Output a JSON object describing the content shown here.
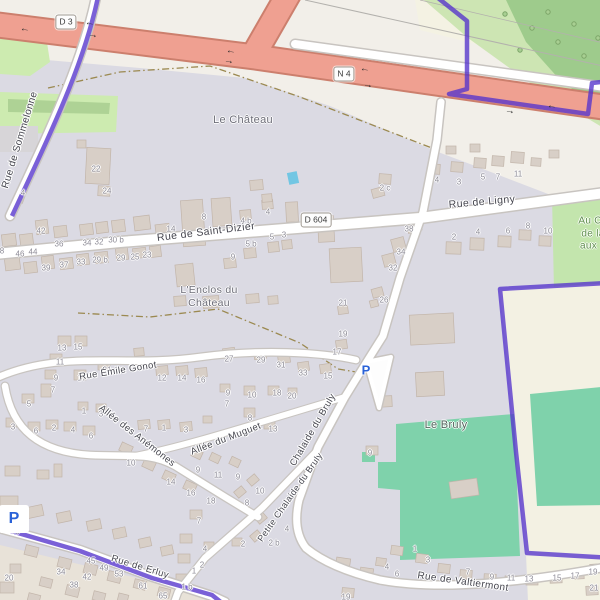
{
  "map": {
    "shields": [
      {
        "t": "D 3",
        "x": 66,
        "y": 22
      },
      {
        "t": "N 4",
        "x": 344,
        "y": 74
      },
      {
        "t": "D 604",
        "x": 316,
        "y": 220
      }
    ],
    "street_labels": [
      {
        "t": "Rue de Sommelonne",
        "x": 20,
        "y": 140,
        "r": -73,
        "s": 10
      },
      {
        "t": "Rue de Saint-Dizier",
        "x": 206,
        "y": 232,
        "r": -7,
        "s": 10.5
      },
      {
        "t": "Rue de Ligny",
        "x": 482,
        "y": 202,
        "r": -5,
        "s": 10.5
      },
      {
        "t": "Rue Émile Gonot",
        "x": 118,
        "y": 371,
        "r": -9,
        "s": 9.5
      },
      {
        "t": "Allée des Anémones",
        "x": 137,
        "y": 436,
        "r": 38,
        "s": 9.5
      },
      {
        "t": "Allée du Muguet",
        "x": 226,
        "y": 439,
        "r": -21,
        "s": 9.5
      },
      {
        "t": "Chalaide du Bruly",
        "x": 313,
        "y": 430,
        "r": -60,
        "s": 9.5
      },
      {
        "t": "Petite Chalaide du Bruly",
        "x": 290,
        "y": 497,
        "r": -55,
        "s": 9
      },
      {
        "t": "Rue de Erluy",
        "x": 140,
        "y": 567,
        "r": 17,
        "s": 9.5
      },
      {
        "t": "Rue de Valtiermont",
        "x": 463,
        "y": 582,
        "r": 8,
        "s": 10
      }
    ],
    "place_labels": [
      {
        "t": "Le Château",
        "x": 243,
        "y": 120,
        "s": 11,
        "c": "#6d6d78"
      },
      {
        "lines": [
          "L'Enclos du",
          "Château"
        ],
        "x": 209,
        "y": 297,
        "s": 10.5,
        "c": "#6d6d78"
      },
      {
        "t": "Le Bruly",
        "x": 446,
        "y": 425,
        "s": 11,
        "c": "#55655d"
      },
      {
        "lines": [
          "Au Ch",
          "de la",
          "aux L"
        ],
        "x": 593,
        "y": 234,
        "s": 10,
        "c": "#5f8f4d"
      }
    ],
    "parking_icons": [
      {
        "t": "P",
        "x": 366,
        "y": 370
      },
      {
        "t": "P",
        "x": 14,
        "y": 519,
        "b": true
      }
    ],
    "oneway_arrows": [
      {
        "g": "←",
        "x": 25,
        "y": 29,
        "r": 9
      },
      {
        "g": "←",
        "x": 90,
        "y": 23,
        "r": 9
      },
      {
        "g": "→",
        "x": 93,
        "y": 35,
        "r": 9
      },
      {
        "g": "←",
        "x": 231,
        "y": 51,
        "r": 9
      },
      {
        "g": "→",
        "x": 229,
        "y": 61,
        "r": 9
      },
      {
        "g": "←",
        "x": 365,
        "y": 69,
        "r": 9
      },
      {
        "g": "→",
        "x": 368,
        "y": 85,
        "r": 9
      },
      {
        "g": "→",
        "x": 510,
        "y": 111,
        "r": 9
      },
      {
        "g": "←",
        "x": 552,
        "y": 106,
        "r": 9
      }
    ],
    "house_numbers": [
      {
        "t": "8",
        "x": 2,
        "y": 251
      },
      {
        "t": "46",
        "x": 20,
        "y": 254
      },
      {
        "t": "44",
        "x": 33,
        "y": 252
      },
      {
        "t": "42",
        "x": 41,
        "y": 231
      },
      {
        "t": "36",
        "x": 59,
        "y": 244
      },
      {
        "t": "34",
        "x": 87,
        "y": 243
      },
      {
        "t": "32",
        "x": 99,
        "y": 242
      },
      {
        "t": "30 b",
        "x": 116,
        "y": 240
      },
      {
        "t": "39",
        "x": 46,
        "y": 268
      },
      {
        "t": "37",
        "x": 64,
        "y": 265
      },
      {
        "t": "33",
        "x": 81,
        "y": 262
      },
      {
        "t": "29 b",
        "x": 100,
        "y": 260
      },
      {
        "t": "29",
        "x": 121,
        "y": 258
      },
      {
        "t": "25",
        "x": 135,
        "y": 257
      },
      {
        "t": "23",
        "x": 147,
        "y": 255
      },
      {
        "t": "14",
        "x": 171,
        "y": 229
      },
      {
        "t": "8",
        "x": 204,
        "y": 217
      },
      {
        "t": "4 b",
        "x": 246,
        "y": 221
      },
      {
        "t": "4",
        "x": 268,
        "y": 212
      },
      {
        "t": "5 b",
        "x": 251,
        "y": 244
      },
      {
        "t": "5",
        "x": 272,
        "y": 237
      },
      {
        "t": "3",
        "x": 284,
        "y": 235
      },
      {
        "t": "9",
        "x": 233,
        "y": 257
      },
      {
        "t": "22",
        "x": 96,
        "y": 169
      },
      {
        "t": "24",
        "x": 107,
        "y": 191
      },
      {
        "t": "4",
        "x": 23,
        "y": 193
      },
      {
        "t": "2 c",
        "x": 385,
        "y": 188
      },
      {
        "t": "4",
        "x": 437,
        "y": 180
      },
      {
        "t": "3",
        "x": 459,
        "y": 182
      },
      {
        "t": "5",
        "x": 483,
        "y": 177
      },
      {
        "t": "7",
        "x": 498,
        "y": 177
      },
      {
        "t": "11",
        "x": 518,
        "y": 174
      },
      {
        "t": "2",
        "x": 454,
        "y": 237
      },
      {
        "t": "4",
        "x": 478,
        "y": 232
      },
      {
        "t": "6",
        "x": 508,
        "y": 231
      },
      {
        "t": "8",
        "x": 528,
        "y": 226
      },
      {
        "t": "10",
        "x": 548,
        "y": 231
      },
      {
        "t": "38",
        "x": 409,
        "y": 229
      },
      {
        "t": "34",
        "x": 401,
        "y": 252
      },
      {
        "t": "32",
        "x": 393,
        "y": 268
      },
      {
        "t": "26",
        "x": 384,
        "y": 300
      },
      {
        "t": "21",
        "x": 343,
        "y": 303
      },
      {
        "t": "19",
        "x": 343,
        "y": 334
      },
      {
        "t": "17",
        "x": 337,
        "y": 352
      },
      {
        "t": "15",
        "x": 328,
        "y": 376
      },
      {
        "t": "33",
        "x": 303,
        "y": 373
      },
      {
        "t": "31",
        "x": 281,
        "y": 365
      },
      {
        "t": "18",
        "x": 277,
        "y": 393
      },
      {
        "t": "20",
        "x": 292,
        "y": 396
      },
      {
        "t": "13",
        "x": 273,
        "y": 429
      },
      {
        "t": "13",
        "x": 62,
        "y": 348
      },
      {
        "t": "15",
        "x": 78,
        "y": 347
      },
      {
        "t": "11",
        "x": 60,
        "y": 362
      },
      {
        "t": "9",
        "x": 56,
        "y": 378
      },
      {
        "t": "7",
        "x": 53,
        "y": 390
      },
      {
        "t": "17",
        "x": 82,
        "y": 378
      },
      {
        "t": "21",
        "x": 107,
        "y": 370
      },
      {
        "t": "12",
        "x": 162,
        "y": 378
      },
      {
        "t": "14",
        "x": 182,
        "y": 378
      },
      {
        "t": "16",
        "x": 201,
        "y": 380
      },
      {
        "t": "27",
        "x": 229,
        "y": 359
      },
      {
        "t": "29",
        "x": 261,
        "y": 360
      },
      {
        "t": "9",
        "x": 228,
        "y": 393
      },
      {
        "t": "7",
        "x": 227,
        "y": 404
      },
      {
        "t": "10",
        "x": 252,
        "y": 395
      },
      {
        "t": "5",
        "x": 29,
        "y": 404
      },
      {
        "t": "3",
        "x": 13,
        "y": 427
      },
      {
        "t": "6",
        "x": 36,
        "y": 431
      },
      {
        "t": "2",
        "x": 54,
        "y": 428
      },
      {
        "t": "4",
        "x": 73,
        "y": 430
      },
      {
        "t": "6",
        "x": 91,
        "y": 436
      },
      {
        "t": "1",
        "x": 84,
        "y": 411
      },
      {
        "t": "3",
        "x": 101,
        "y": 414
      },
      {
        "t": "7",
        "x": 146,
        "y": 429
      },
      {
        "t": "1",
        "x": 164,
        "y": 428
      },
      {
        "t": "3",
        "x": 186,
        "y": 430
      },
      {
        "t": "8",
        "x": 250,
        "y": 418
      },
      {
        "t": "10",
        "x": 131,
        "y": 463
      },
      {
        "t": "14",
        "x": 171,
        "y": 482
      },
      {
        "t": "16",
        "x": 191,
        "y": 493
      },
      {
        "t": "18",
        "x": 211,
        "y": 501
      },
      {
        "t": "9",
        "x": 198,
        "y": 470
      },
      {
        "t": "11",
        "x": 218,
        "y": 475
      },
      {
        "t": "9",
        "x": 238,
        "y": 477
      },
      {
        "t": "7",
        "x": 199,
        "y": 521
      },
      {
        "t": "10",
        "x": 260,
        "y": 491
      },
      {
        "t": "8",
        "x": 247,
        "y": 503
      },
      {
        "t": "4",
        "x": 287,
        "y": 529
      },
      {
        "t": "2 b",
        "x": 274,
        "y": 543
      },
      {
        "t": "2",
        "x": 243,
        "y": 544
      },
      {
        "t": "4",
        "x": 205,
        "y": 549
      },
      {
        "t": "2",
        "x": 202,
        "y": 565
      },
      {
        "t": "1",
        "x": 194,
        "y": 571
      },
      {
        "t": "1 b",
        "x": 187,
        "y": 587
      },
      {
        "t": "41",
        "x": 15,
        "y": 531
      },
      {
        "t": "45",
        "x": 91,
        "y": 561
      },
      {
        "t": "49",
        "x": 104,
        "y": 568
      },
      {
        "t": "53",
        "x": 119,
        "y": 574
      },
      {
        "t": "61",
        "x": 143,
        "y": 586
      },
      {
        "t": "65",
        "x": 163,
        "y": 596
      },
      {
        "t": "34",
        "x": 61,
        "y": 572
      },
      {
        "t": "38",
        "x": 74,
        "y": 585
      },
      {
        "t": "42",
        "x": 87,
        "y": 577
      },
      {
        "t": "20",
        "x": 9,
        "y": 578
      },
      {
        "t": "4",
        "x": 387,
        "y": 567
      },
      {
        "t": "6",
        "x": 397,
        "y": 574
      },
      {
        "t": "1",
        "x": 415,
        "y": 549
      },
      {
        "t": "3",
        "x": 428,
        "y": 560
      },
      {
        "t": "7",
        "x": 468,
        "y": 572
      },
      {
        "t": "9",
        "x": 492,
        "y": 577
      },
      {
        "t": "11",
        "x": 511,
        "y": 578
      },
      {
        "t": "13",
        "x": 529,
        "y": 579
      },
      {
        "t": "15",
        "x": 557,
        "y": 578
      },
      {
        "t": "17",
        "x": 575,
        "y": 576
      },
      {
        "t": "19",
        "x": 593,
        "y": 572
      },
      {
        "t": "21",
        "x": 594,
        "y": 588
      },
      {
        "t": "19",
        "x": 346,
        "y": 597
      },
      {
        "t": "9",
        "x": 370,
        "y": 453
      }
    ],
    "colors": {
      "residential": "#dbdae3",
      "road_fill": "#ffffff",
      "road_casing": "#c8c4c0",
      "trunk_fill": "#efa091",
      "trunk_casing": "#cc7f6d",
      "boundary": "#5533cc",
      "forest": "#9ecb8c",
      "scrub": "#cde5b3",
      "meadow": "#cdebb0",
      "pitch": "#7fd2ab",
      "farmland": "#f3f1e3",
      "building": "#d8cfc7",
      "water": "#72c6e3",
      "path_dash": "#9b8950"
    }
  }
}
